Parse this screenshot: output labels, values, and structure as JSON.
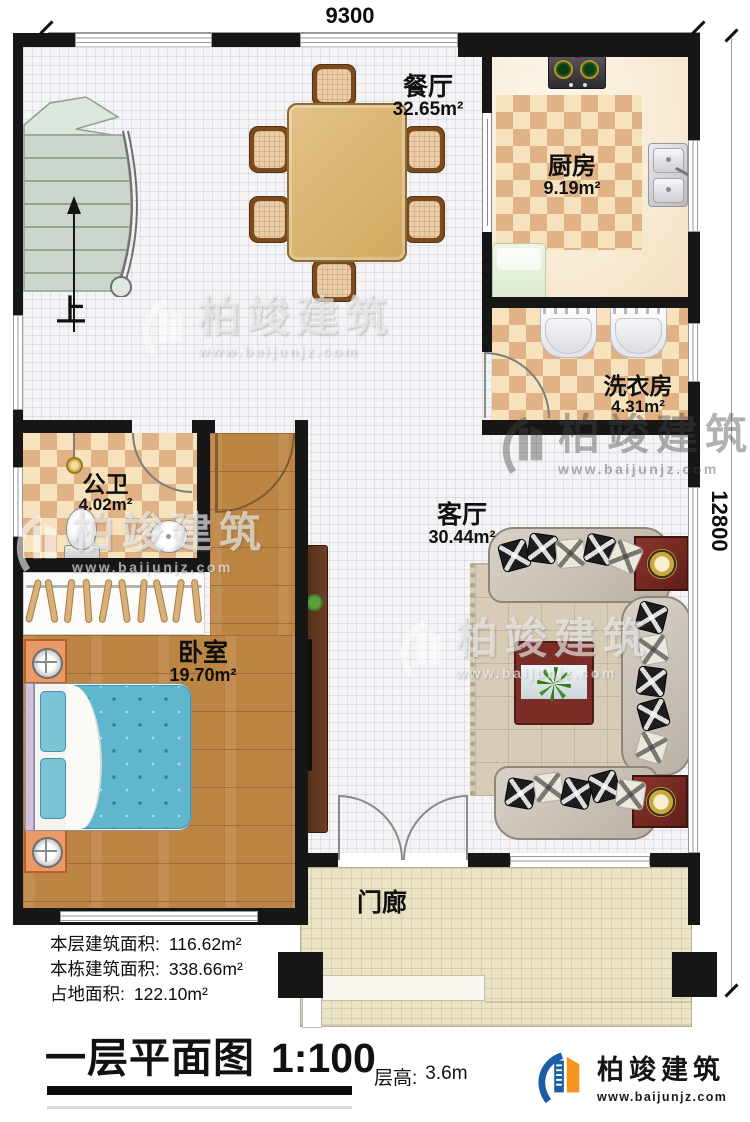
{
  "plan": {
    "type": "floor-plan",
    "floor": "first"
  },
  "dimensions": {
    "width_mm": "9300",
    "height_mm": "12800"
  },
  "rooms": {
    "dining": {
      "name": "餐厅",
      "area": "32.65m²"
    },
    "kitchen": {
      "name": "厨房",
      "area": "9.19m²"
    },
    "laundry": {
      "name": "洗衣房",
      "area": "4.31m²"
    },
    "bathroom": {
      "name": "公卫",
      "area": "4.02m²"
    },
    "bedroom": {
      "name": "卧室",
      "area": "19.70m²"
    },
    "living": {
      "name": "客厅",
      "area": "30.44m²"
    },
    "porch": {
      "name": "门廊"
    }
  },
  "stairs": {
    "direction_label": "上"
  },
  "stats": [
    {
      "label": "本层建筑面积:",
      "value": "116.62m²"
    },
    {
      "label": "本栋建筑面积:",
      "value": "338.66m²"
    },
    {
      "label": "占地面积:",
      "value": "122.10m²"
    }
  ],
  "title": {
    "text": "一层平面图",
    "scale": "1:100"
  },
  "floor_height": {
    "label": "层高:",
    "value": "3.6m"
  },
  "brand": {
    "name": "柏竣建筑",
    "url": "www.baijunjz.com"
  },
  "watermark": {
    "name": "柏竣建筑",
    "url": "www.baijunjz.com"
  },
  "colors": {
    "wall": "#161616",
    "checker_dark": "#e0b286",
    "checker_light": "#f6e3bd",
    "wood_floor": "#bd8544",
    "bed_blanket": "#5fb6cd",
    "rug": "#d9ccb6",
    "brand_blue": "#1b5ea6",
    "brand_orange": "#f7941d"
  }
}
